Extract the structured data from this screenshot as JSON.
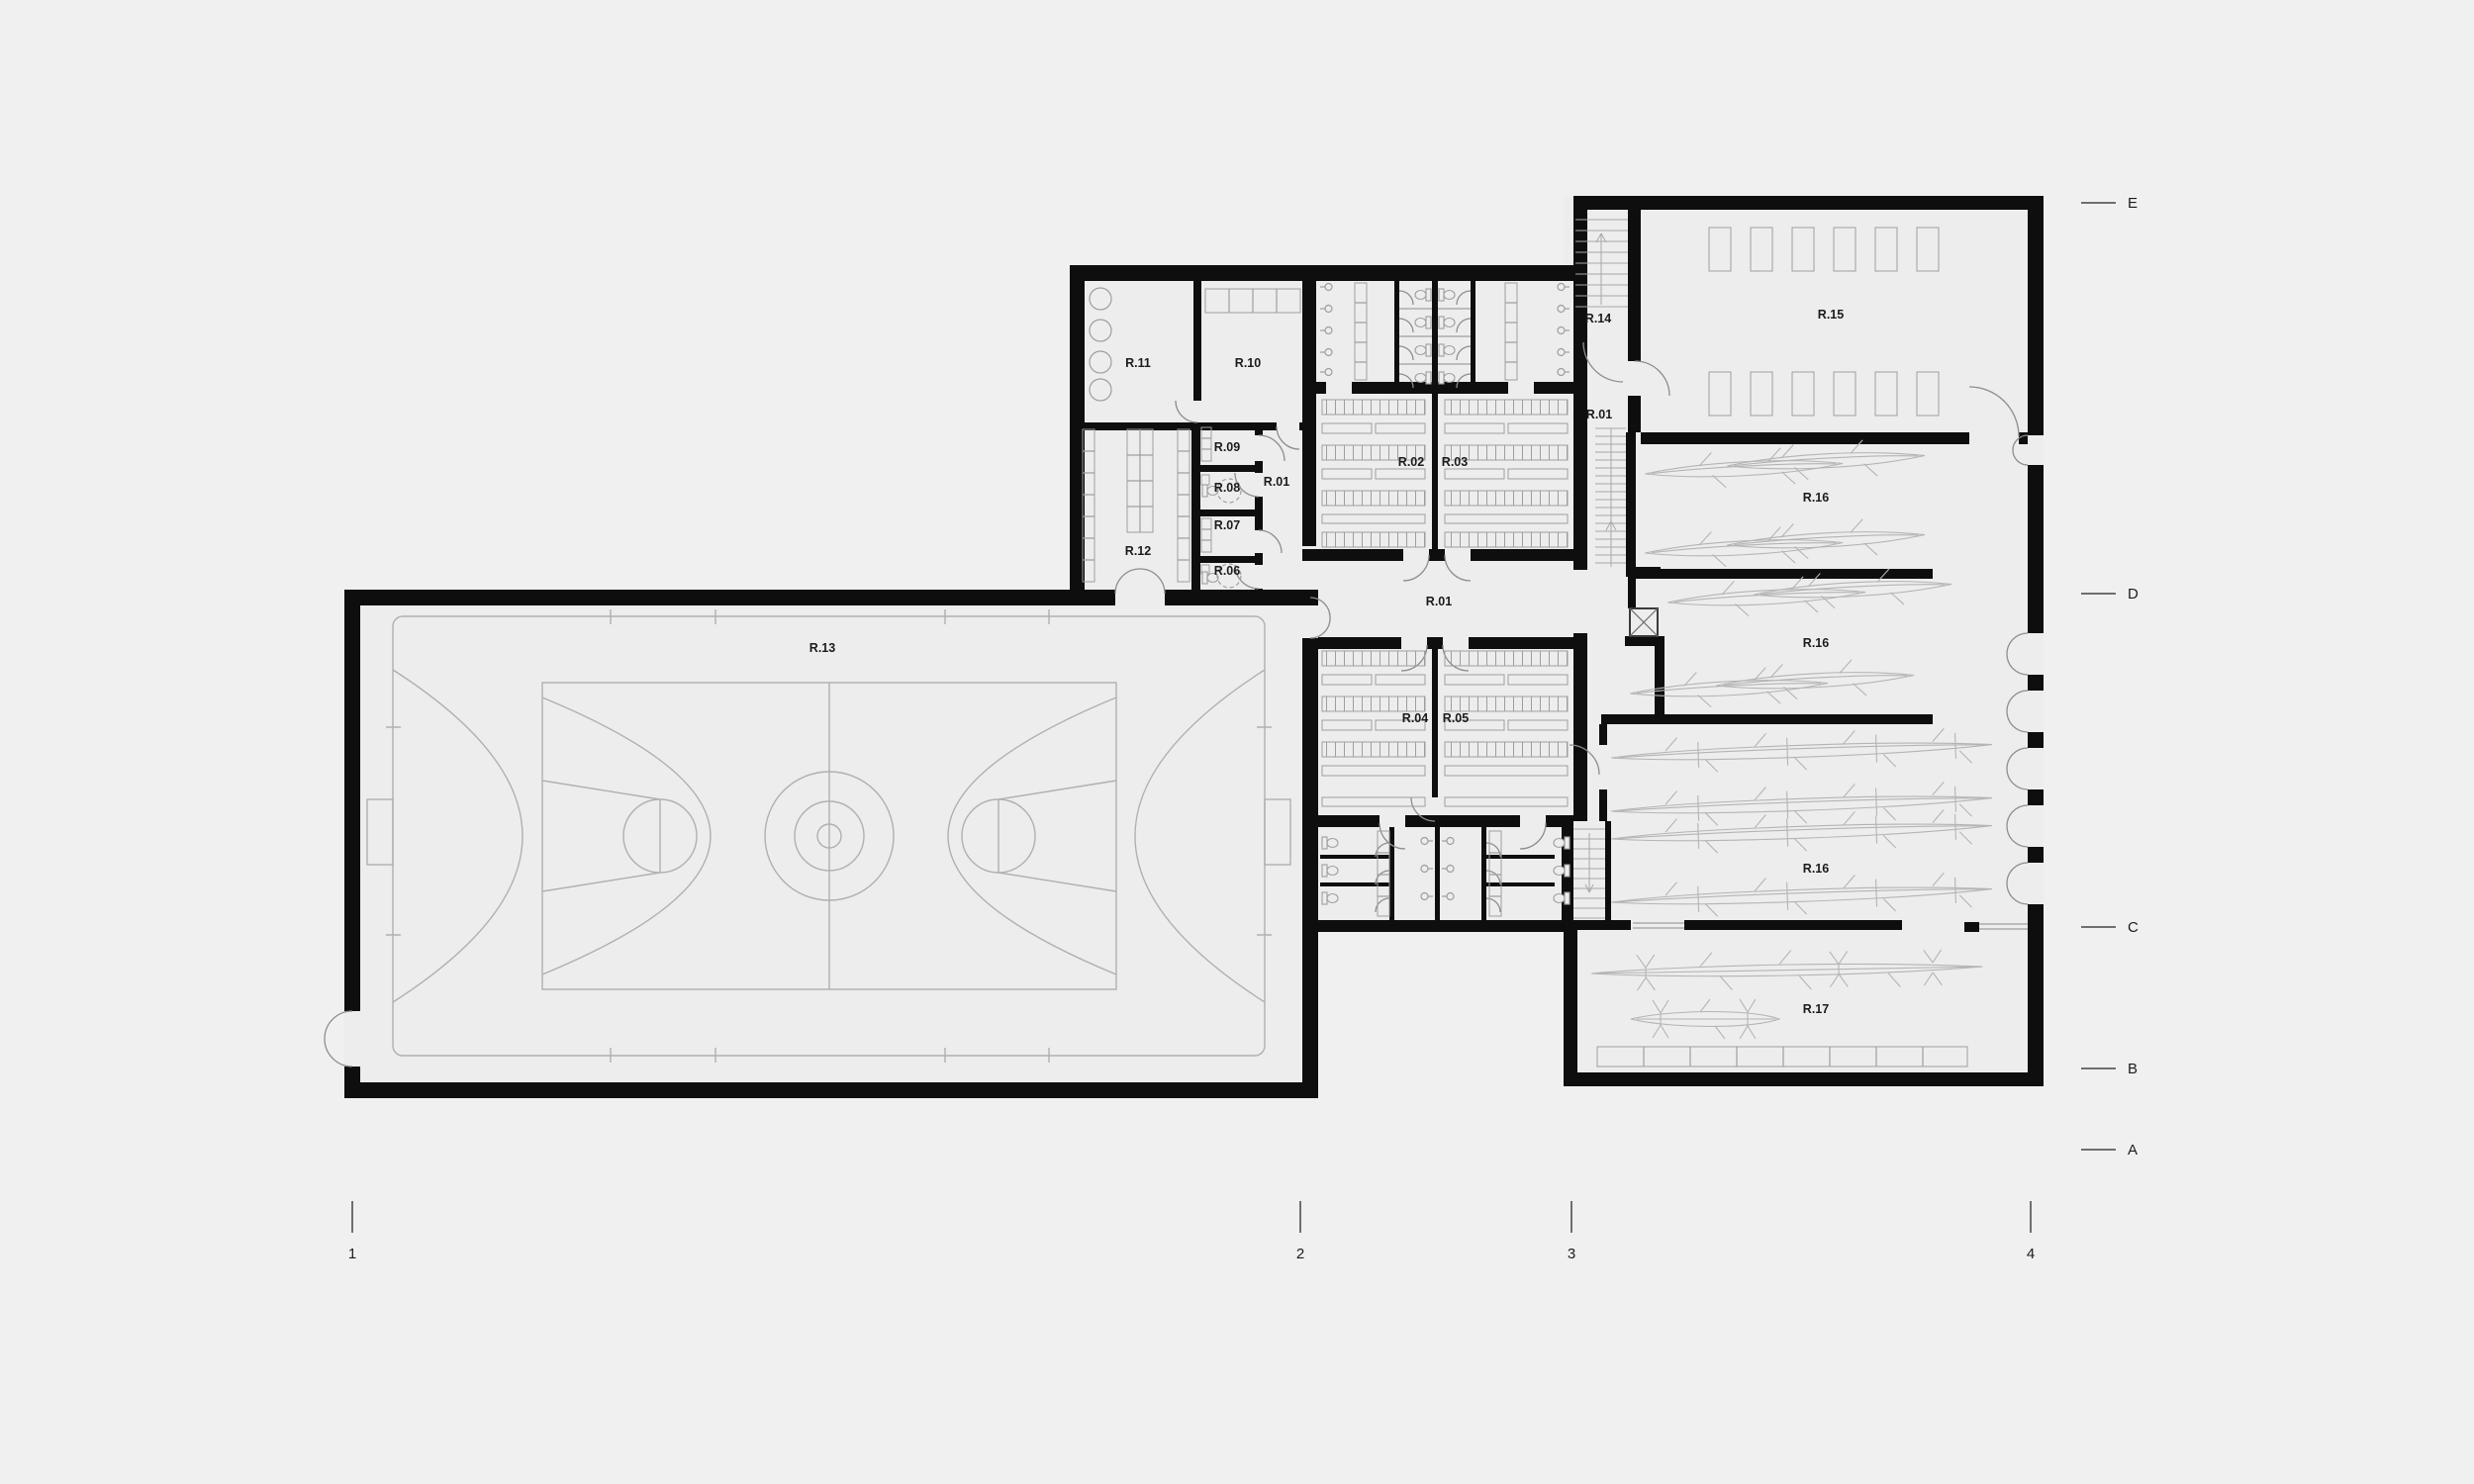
{
  "rooms": {
    "r01a": "R.01",
    "r01b": "R.01",
    "r01c": "R.01",
    "r02": "R.02",
    "r03": "R.03",
    "r04": "R.04",
    "r05": "R.05",
    "r06": "R.06",
    "r07": "R.07",
    "r08": "R.08",
    "r09": "R.09",
    "r10": "R.10",
    "r11": "R.11",
    "r12": "R.12",
    "r13": "R.13",
    "r14": "R.14",
    "r15": "R.15",
    "r16a": "R.16",
    "r16b": "R.16",
    "r16c": "R.16",
    "r17": "R.17"
  },
  "grid_axes": {
    "horizontal": [
      "E",
      "D",
      "C",
      "B",
      "A"
    ],
    "vertical": [
      "1",
      "2",
      "3",
      "4"
    ]
  },
  "colors": {
    "background": "#f0f0f0",
    "floor": "#ededed",
    "wall": "#0e0e0e",
    "furniture_line": "#9e9e9e",
    "court_line": "#b0b0b0",
    "boat_line": "#b4b4b4",
    "door_line": "#8d8d8d",
    "text": "#1b1b1b",
    "grid_tick": "#6f6f6f"
  }
}
